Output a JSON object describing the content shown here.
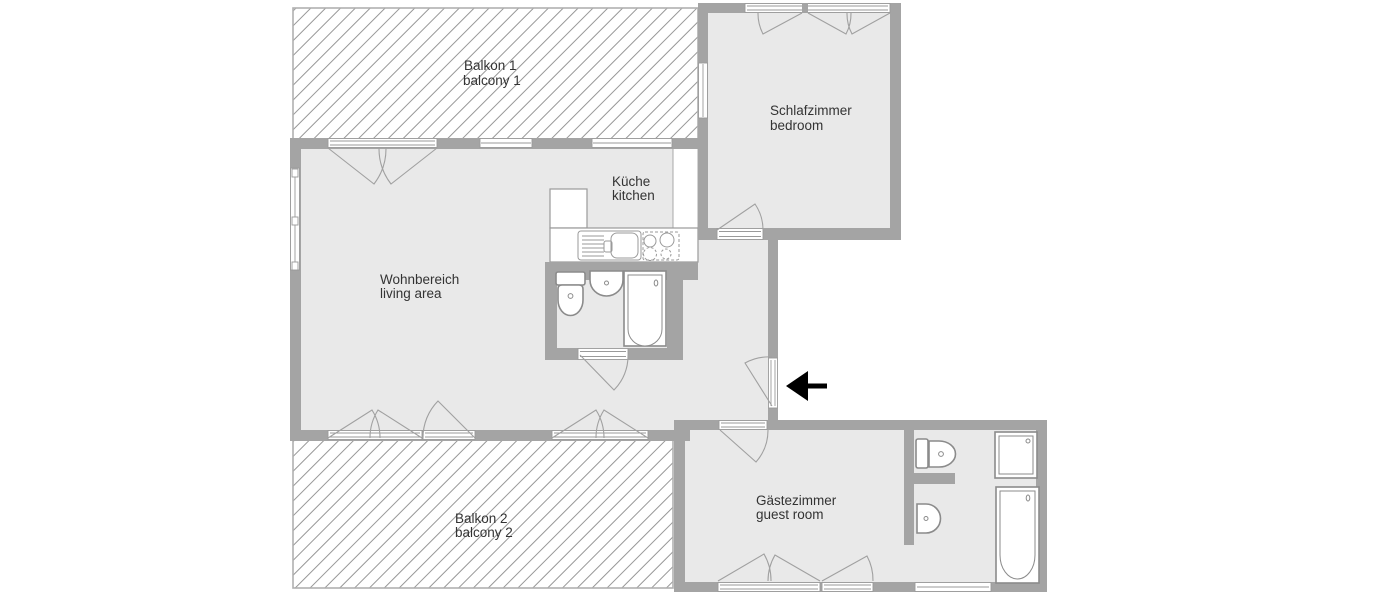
{
  "plan": {
    "type": "apartment-floor-plan",
    "rooms": [
      {
        "id": "balcony-1",
        "label_de": "Balkon 1",
        "label_en": "balcony 1"
      },
      {
        "id": "bedroom",
        "label_de": "Schlafzimmer",
        "label_en": "bedroom"
      },
      {
        "id": "kitchen",
        "label_de": "Küche",
        "label_en": "kitchen"
      },
      {
        "id": "living-area",
        "label_de": "Wohnbereich",
        "label_en": "living area"
      },
      {
        "id": "guest-room",
        "label_de": "Gästezimmer",
        "label_en": "guest room"
      },
      {
        "id": "balcony-2",
        "label_de": "Balkon 2",
        "label_en": "balcony 2"
      }
    ],
    "fixtures": [
      "kitchen-counter",
      "kitchen-sink",
      "stove",
      "fridge-cabinet",
      "toilet",
      "washbasin",
      "bathtub",
      "shower",
      "entrance-arrow",
      "door-swing",
      "window"
    ],
    "colors": {
      "background": "#ffffff",
      "wall": "#a4a4a4",
      "floor": "#e9e9e9",
      "fixture_outline": "#8b8b8b",
      "window_outline": "#9a9a9a",
      "hatch_line": "#979797",
      "label_text": "#333333",
      "arrow": "#000000"
    }
  }
}
